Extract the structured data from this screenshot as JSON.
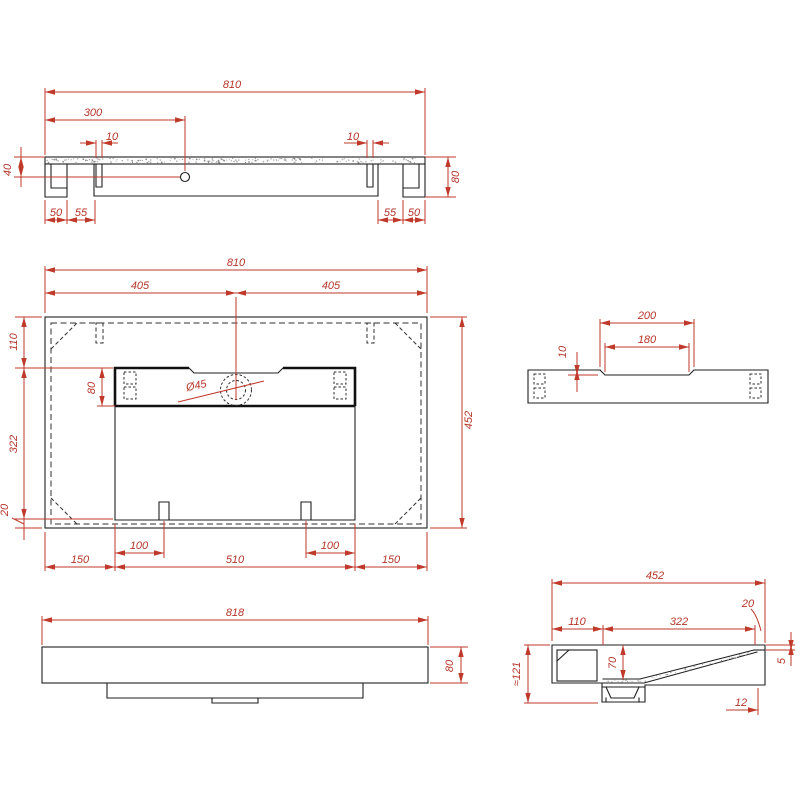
{
  "drawing": {
    "type": "washbasin technical drawing",
    "colors": {
      "dimension_red": "#bf3a2b",
      "line_black": "#1f1f1f",
      "background": "#ffffff"
    },
    "views": {
      "bottom_edge": {
        "dims": {
          "overall_width": "810",
          "hole_offset": "300",
          "slot_left": "10",
          "slot_right": "10",
          "hole_height": "40",
          "overall_height": "80",
          "foot_left": "50",
          "gap_left": "55",
          "gap_right": "55",
          "foot_right": "50"
        }
      },
      "plan": {
        "dims": {
          "overall_width": "810",
          "half_left": "405",
          "half_right": "405",
          "back_offset": "110",
          "bowl_length": "322",
          "front_offset": "20",
          "overall_depth": "452",
          "deck_height": "80",
          "drain_diameter": "Ø45",
          "margin_left": "150",
          "clip_left": "100",
          "bowl_width": "510",
          "clip_right": "100",
          "margin_right": "150"
        }
      },
      "side_recess": {
        "dims": {
          "recess_outer": "200",
          "recess_inner": "180",
          "recess_depth": "10"
        }
      },
      "front_elevation": {
        "dims": {
          "overall_width": "818",
          "overall_height": "80"
        }
      },
      "cross_section": {
        "dims": {
          "overall_depth": "452",
          "back_width": "110",
          "bowl_span": "322",
          "rim_width": "20",
          "bowl_depth": "70",
          "rim_lip": "5",
          "bottom_thickness": "12",
          "overall_height": "≈121"
        }
      }
    }
  }
}
